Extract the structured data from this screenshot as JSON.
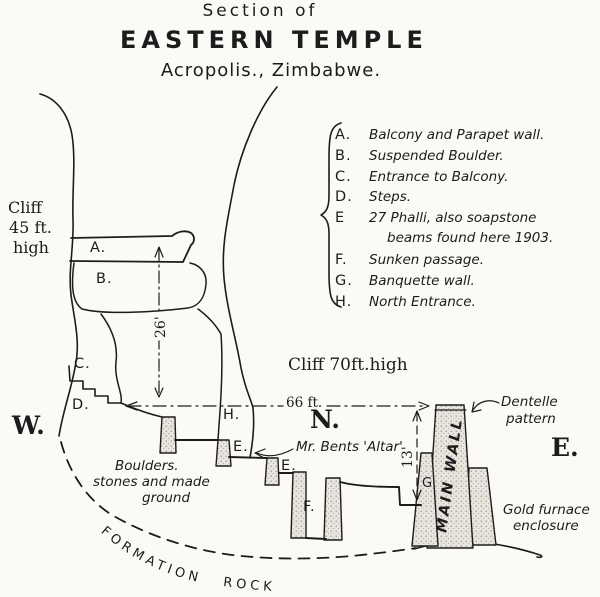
{
  "title": {
    "line1": "Section of",
    "line2": "EASTERN TEMPLE",
    "line3": "Acropolis., Zimbabwe."
  },
  "legend": {
    "items": [
      {
        "key": "A.",
        "text": "Balcony and Parapet wall."
      },
      {
        "key": "B.",
        "text": "Suspended Boulder."
      },
      {
        "key": "C.",
        "text": "Entrance to Balcony."
      },
      {
        "key": "D.",
        "text": "Steps."
      },
      {
        "key": "E",
        "text": "27 Phalli, also soapstone",
        "text2": "beams found here 1903."
      },
      {
        "key": "F.",
        "text": "Sunken passage."
      },
      {
        "key": "G.",
        "text": "Banquette wall."
      },
      {
        "key": "H.",
        "text": "North Entrance."
      }
    ]
  },
  "labels": {
    "cliff_west_1": "Cliff",
    "cliff_west_2": "45 ft.",
    "cliff_west_3": "high",
    "cliff_east": "Cliff 70ft.high",
    "compass_w": "W.",
    "compass_n": "N.",
    "compass_e": "E.",
    "dim_66": "66 ft.",
    "dim_26": "26'",
    "dim_13": "13'",
    "marker_a": "A.",
    "marker_b": "B.",
    "marker_c": "C.",
    "marker_d": "D.",
    "marker_h": "H.",
    "marker_e1": "E.",
    "marker_e2": "E.",
    "marker_f": "F.",
    "marker_g": "G",
    "altar": "Mr. Bents 'Altar'",
    "dentelle_1": "Dentelle",
    "dentelle_2": "pattern",
    "gold_1": "Gold furnace",
    "gold_2": "enclosure",
    "boulders_1": "Boulders.",
    "boulders_2": "stones and made",
    "boulders_3": "ground",
    "main_wall": "MAIN WALL",
    "formation_rock": "FORMATION  ROCK"
  },
  "colors": {
    "ink": "#1c1c1c",
    "paper": "#fbfaf7",
    "wall_fill": "#e7e5de",
    "wall_dot": "#8f8b80"
  }
}
